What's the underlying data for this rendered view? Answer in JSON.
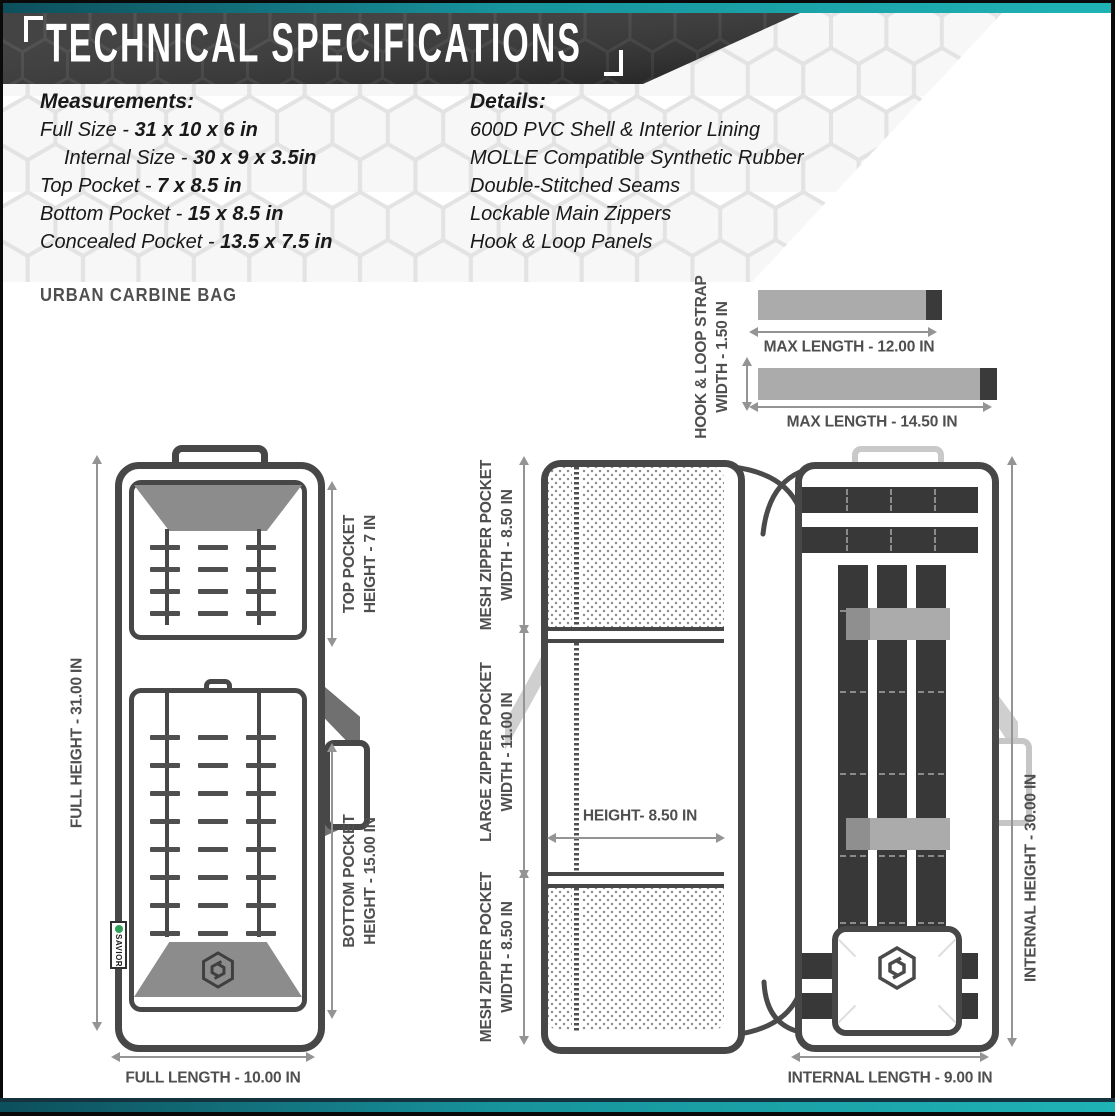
{
  "header": {
    "title": "TECHNICAL SPECIFICATIONS"
  },
  "measurements": {
    "heading": "Measurements:",
    "items": [
      {
        "label": "Full Size - ",
        "value": "31 x 10 x 6 in"
      },
      {
        "label": "Internal Size - ",
        "value": "30 x 9 x 3.5in"
      },
      {
        "label": "Top Pocket - ",
        "value": "7 x 8.5 in"
      },
      {
        "label": "Bottom Pocket - ",
        "value": "15 x 8.5 in"
      },
      {
        "label": "Concealed Pocket - ",
        "value": "13.5 x 7.5 in"
      }
    ]
  },
  "details": {
    "heading": "Details:",
    "items": [
      "600D PVC Shell & Interior Lining",
      "MOLLE Compatible Synthetic Rubber",
      "Double-Stitched Seams",
      "Lockable Main Zippers",
      "Hook & Loop Panels"
    ]
  },
  "product_label": "URBAN CARBINE BAG",
  "strap_diagram": {
    "width_label_line1": "HOOK & LOOP STRAP",
    "width_label_line2": "WIDTH - 1.50 IN",
    "strap1_length": "MAX LENGTH - 12.00 IN",
    "strap2_length": "MAX LENGTH - 14.50 IN"
  },
  "front_view": {
    "full_height": "FULL HEIGHT - 31.00 IN",
    "top_pocket_line1": "TOP POCKET",
    "top_pocket_line2": "HEIGHT - 7 IN",
    "bottom_pocket_line1": "BOTTOM POCKET",
    "bottom_pocket_line2": "HEIGHT - 15.00 IN",
    "full_length": "FULL LENGTH - 10.00 IN",
    "brand_tag": "SAVIOR"
  },
  "open_view": {
    "mesh_top_line1": "MESH ZIPPER POCKET",
    "mesh_top_line2": "WIDTH - 8.50 IN",
    "large_line1": "LARGE ZIPPER POCKET",
    "large_line2": "WIDTH - 11.00 IN",
    "height_label": "HEIGHT- 8.50 IN",
    "mesh_bottom_line1": "MESH ZIPPER POCKET",
    "mesh_bottom_line2": "WIDTH - 8.50 IN"
  },
  "internal_view": {
    "internal_height": "INTERNAL HEIGHT - 30.00 IN",
    "internal_length": "INTERNAL LENGTH - 9.00 IN"
  },
  "colors": {
    "accent_teal": "#1fb3b5",
    "dark_band": "#2e2e2e",
    "bag_outline": "#474747",
    "dimension_gray": "#949494",
    "label_gray": "#4f4f4f",
    "panel_gray": "#8c8c8c"
  }
}
